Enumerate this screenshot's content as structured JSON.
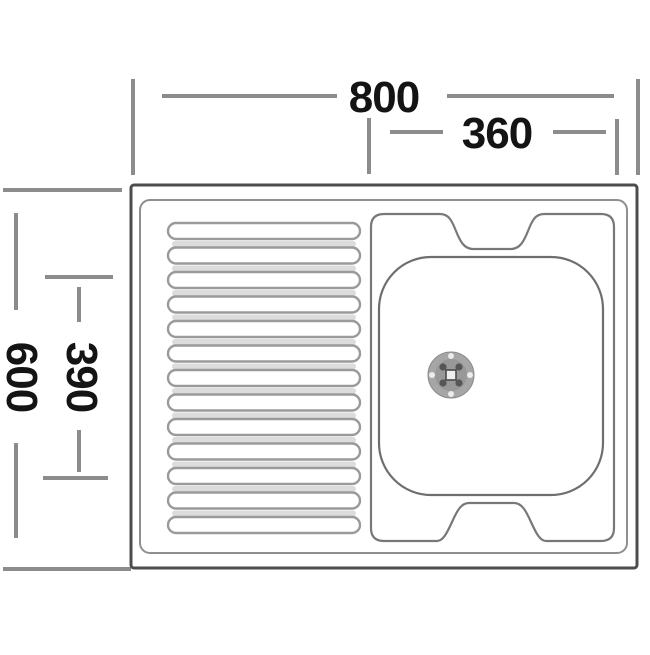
{
  "diagram": {
    "type": "kitchen-sink-top-view-technical-drawing",
    "dimensions": {
      "overall_width_mm": "800",
      "bowl_width_mm": "360",
      "overall_depth_mm": "600",
      "bowl_depth_mm": "390"
    },
    "drainboard": {
      "rib_count": 13
    },
    "colors": {
      "background": "#ffffff",
      "line": "#8c8c8c",
      "rim": "#8f8f8f",
      "outline": "#4d4d4d",
      "bowl": "#6e6e6e",
      "text": "#141414",
      "shadow": "#dcdcdc",
      "drain": "#a6a6a6",
      "drain_dark": "#565656"
    }
  }
}
